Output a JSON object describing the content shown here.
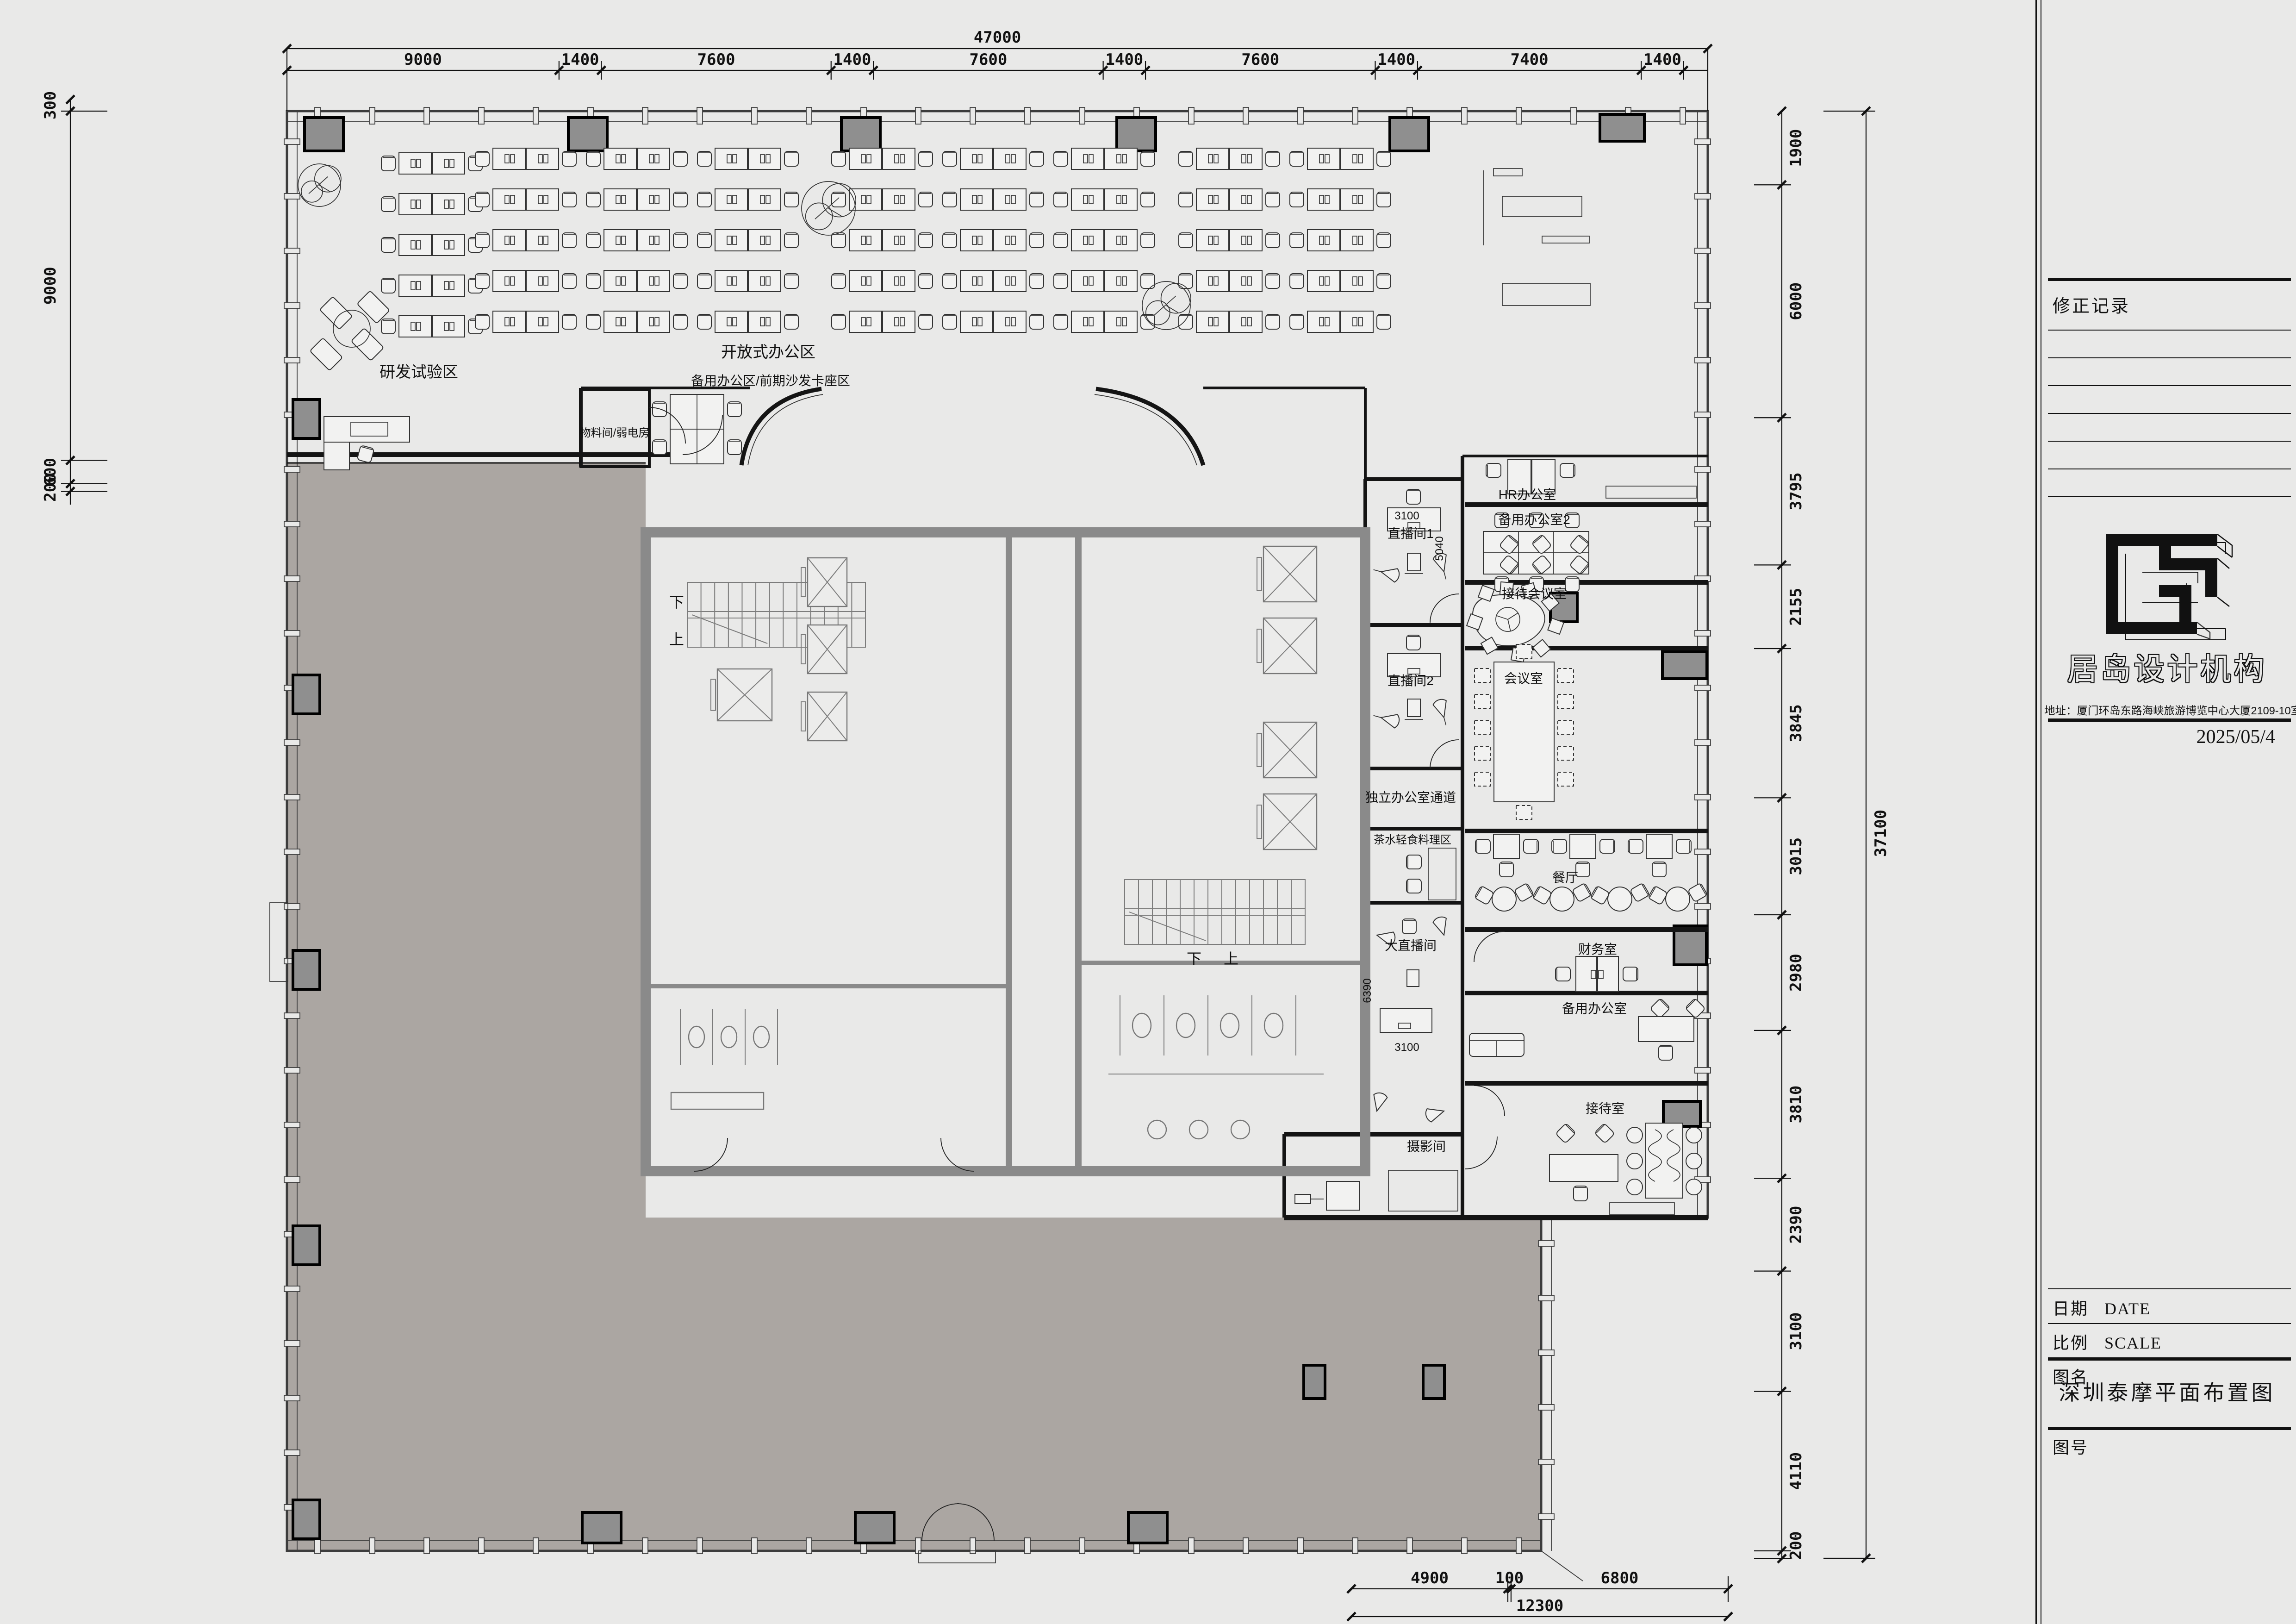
{
  "title_block": {
    "revision_title": "修正记录",
    "company_name": "居岛设计机构",
    "address": "地址：厦门环岛东路海峡旅游博览中心大厦2109-10室",
    "date_value": "2025/05/4",
    "fields": {
      "date_cn": "日期",
      "date_en": "DATE",
      "scale_cn": "比例",
      "scale_en": "SCALE",
      "name_label": "图名",
      "number_label": "图号"
    },
    "drawing_title": "深圳泰摩平面布置图"
  },
  "plan": {
    "rooms": {
      "rnd": "研发试验区",
      "open_office": "开放式办公区",
      "backup_area": "备用办公区/前期沙发卡座区",
      "material": "物料间/弱电房",
      "live1": "直播间1",
      "live2": "直播间2",
      "corridor": "独立办公室通道",
      "tea": "茶水轻食料理区",
      "big_live": "大直播间",
      "photo": "摄影间",
      "hr": "HR办公室",
      "backup2": "备用办公室2",
      "reception_meeting": "接待会议室",
      "meeting": "会议室",
      "dining": "餐厅",
      "finance": "财务室",
      "backup": "备用办公室",
      "reception": "接待室"
    },
    "stair_down": "下",
    "stair_up": "上"
  },
  "dimensions": {
    "top_total": "47000",
    "top_segments": [
      "9000",
      "1400",
      "7600",
      "1400",
      "7600",
      "1400",
      "7600",
      "1400",
      "7400",
      "1400"
    ],
    "left_segments": [
      "300",
      "9000",
      "600",
      "200"
    ],
    "right_segments": [
      "1900",
      "6000",
      "3795",
      "2155",
      "3845",
      "3015",
      "2980",
      "3810",
      "2390",
      "3100",
      "4110",
      "200"
    ],
    "right_total": "37100",
    "bottom_segments": [
      "4900",
      "100",
      "6800"
    ],
    "bottom_total": "12300",
    "room_dims": {
      "live1_w": "3100",
      "live1_h": "5040",
      "big_live_h": "6390",
      "big_live_w": "3100"
    }
  },
  "colors": {
    "background": "#e9e9e8",
    "out_of_scope_floor": "#aba6a2",
    "column_fill": "#8f8f8f",
    "core_wall": "#8a8a8a",
    "line": "#141414"
  }
}
